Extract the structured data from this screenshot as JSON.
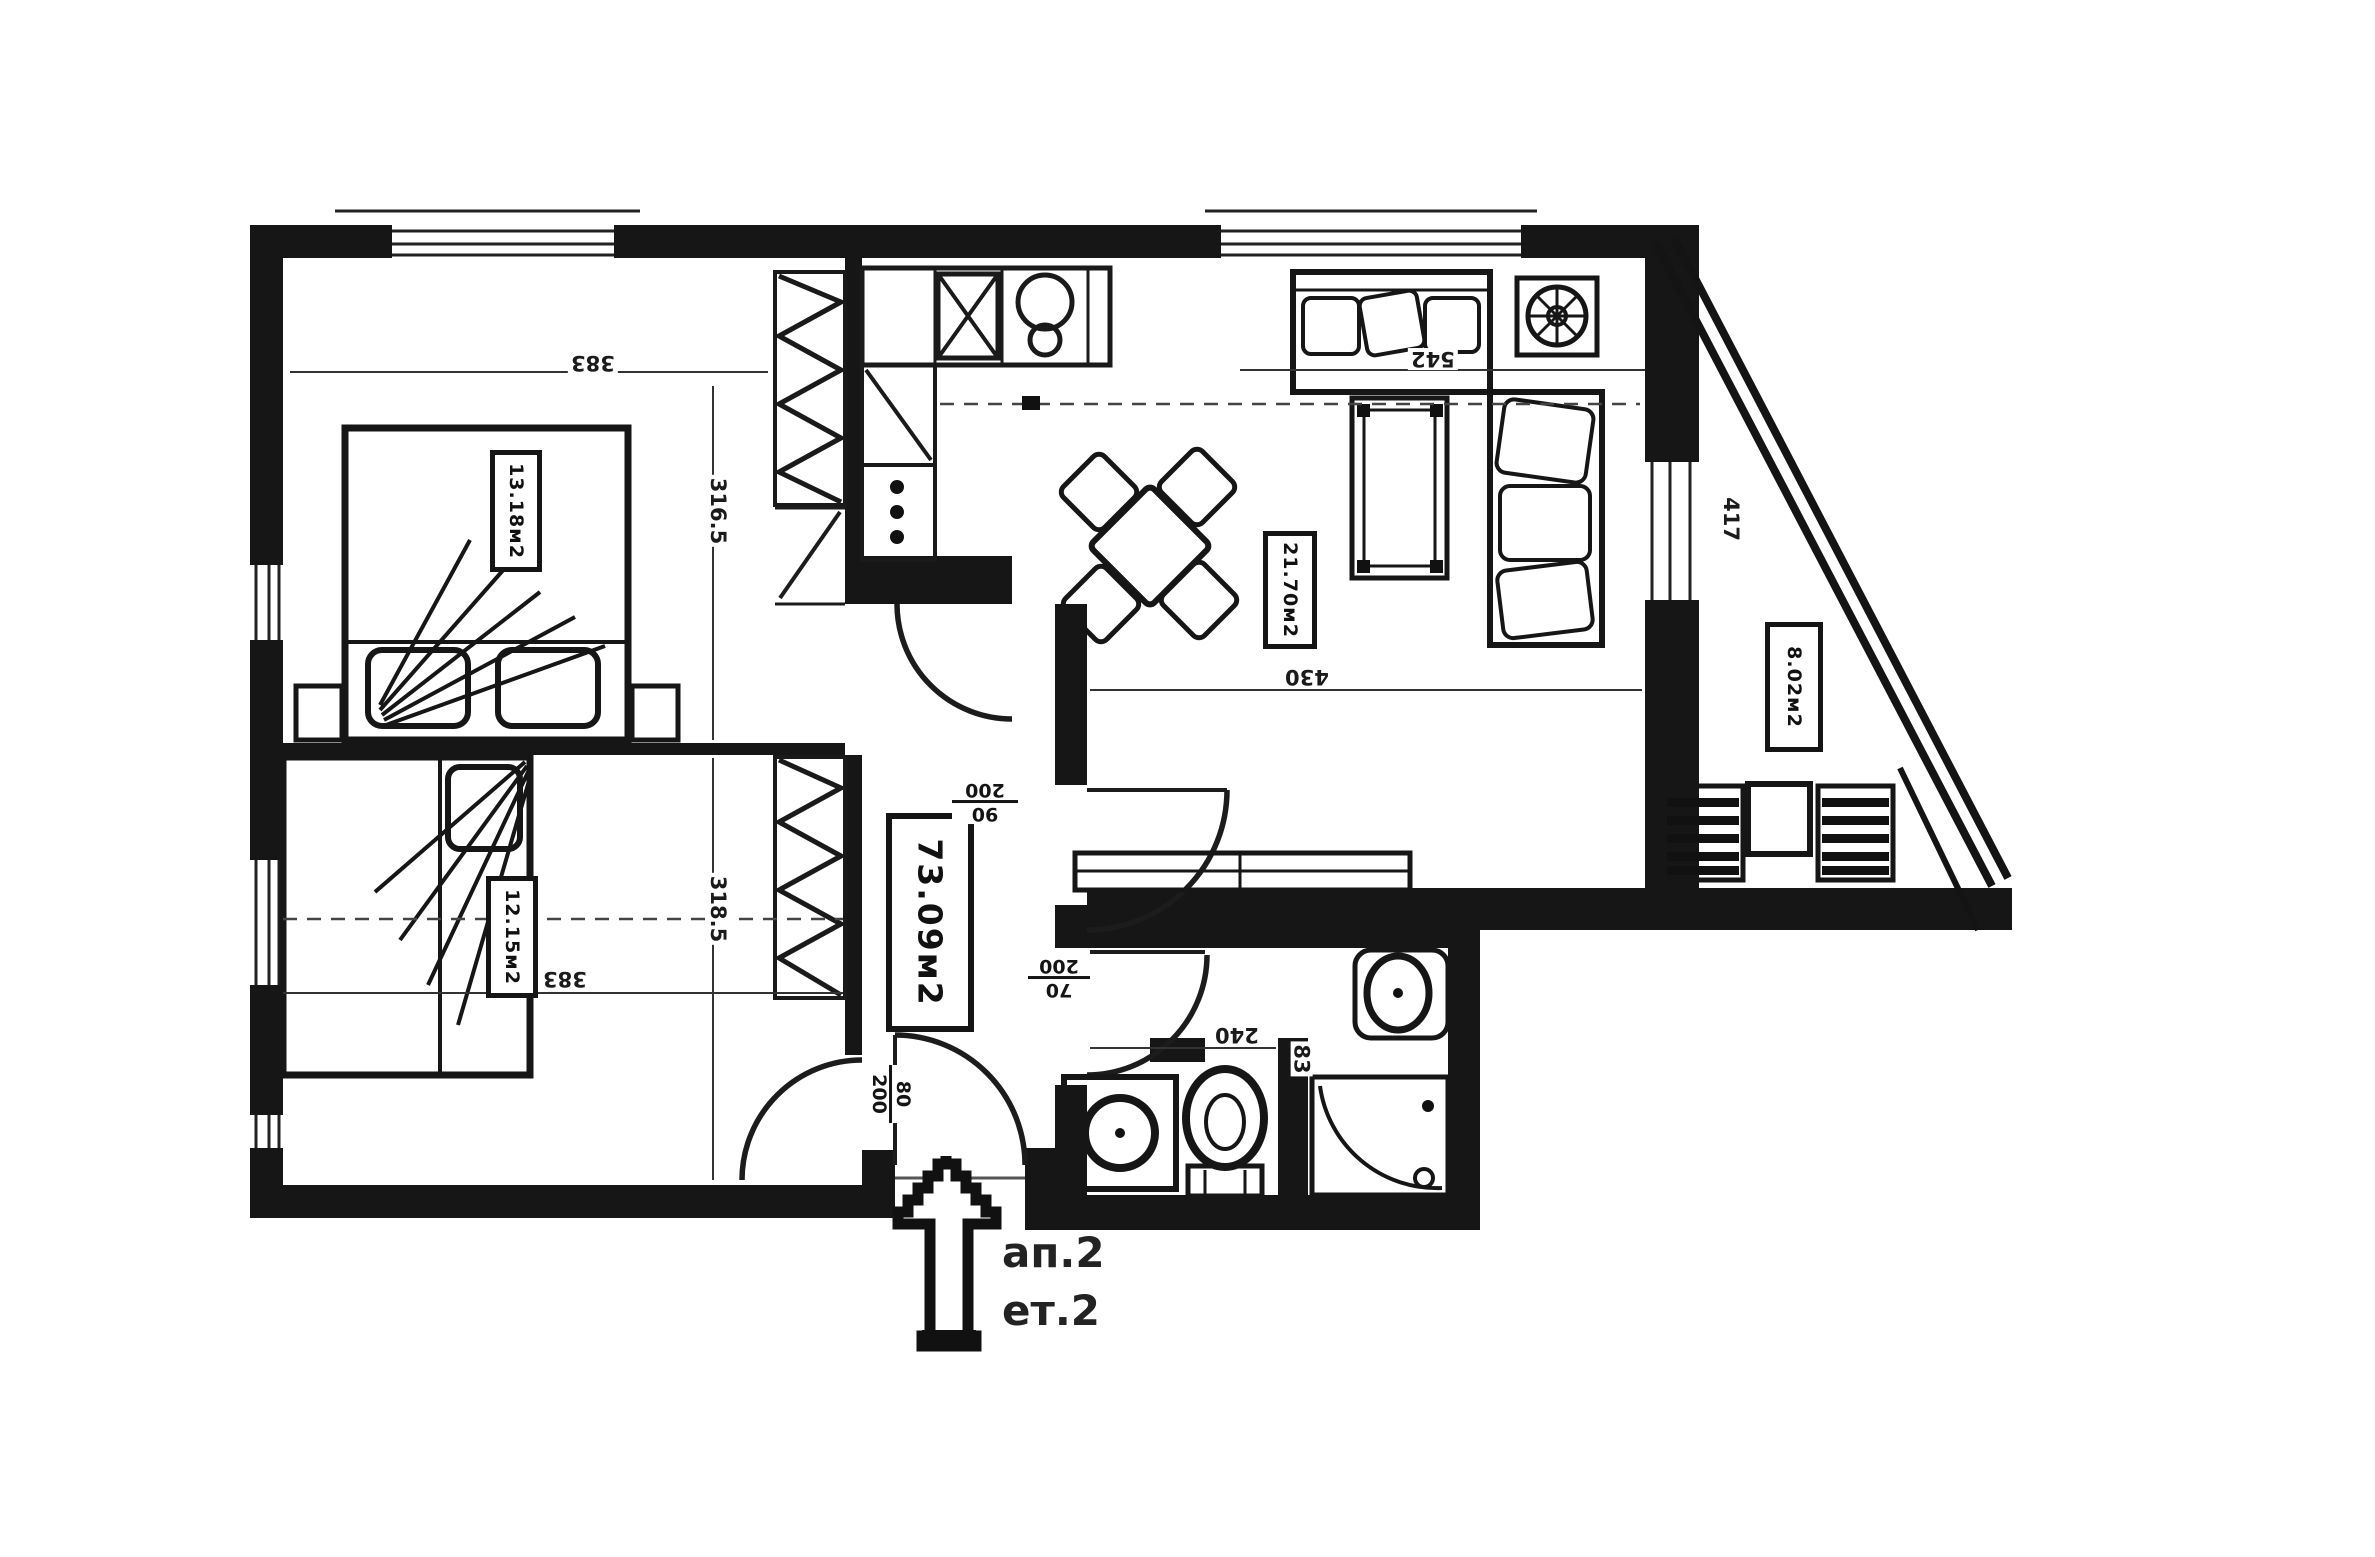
{
  "labels": {
    "total_area": "73.09м2",
    "bedroom1_area": "13.18м2",
    "bedroom2_area": "12.15м2",
    "living_area": "21.70м2",
    "balcony_area": "8.02м2",
    "apartment": "ап.2",
    "floor": "ет.2"
  },
  "dimensions": {
    "bedroom1_width": "383",
    "bedroom1_depth": "316.5",
    "bedroom2_width": "383",
    "bedroom2_depth": "318.5",
    "living_width": "542",
    "living_depth": "430",
    "bathroom_width": "240",
    "bathroom_side": "83",
    "balcony_side": "417"
  },
  "doors": {
    "hall_living": {
      "width": "90",
      "height": "200"
    },
    "bathroom": {
      "width": "70",
      "height": "200"
    },
    "bedroom2": {
      "width": "80",
      "height": "200"
    }
  }
}
